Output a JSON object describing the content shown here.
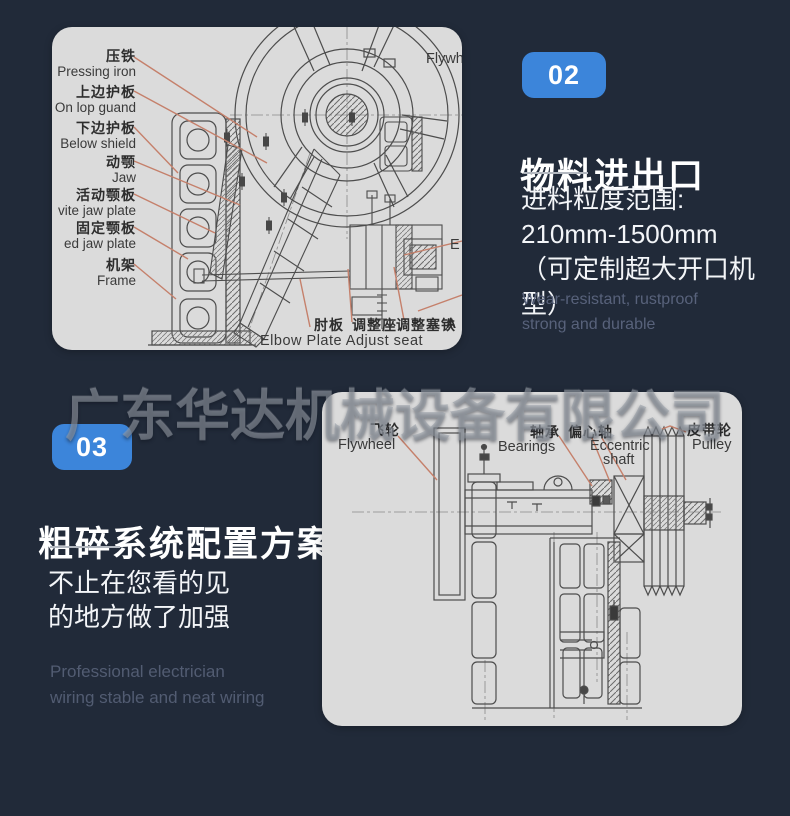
{
  "watermark": "广东华达机械设备有限公司",
  "colors": {
    "background": "#212a39",
    "panel_bg": "#dbdbdb",
    "accent_blue": "#3c85da",
    "leader_line": "#c5806b",
    "diagram_stroke": "#4d4d4d"
  },
  "section2": {
    "badge": "02",
    "title": "物料进出口",
    "lines": "进料粒度范围:\n210mm-1500mm\n（可定制超大开口机型）",
    "subtext": "Wear-resistant, rustproof\nstrong and durable"
  },
  "section3": {
    "badge": "03",
    "title": "粗碎系统配置方案",
    "lines": "不止在您看的见\n的地方做了加强",
    "subtext": "Professional electrician\nwiring stable and neat wiring"
  },
  "diagram1": {
    "labels": [
      {
        "zh": "压铁",
        "en": "Pressing iron"
      },
      {
        "zh": "上边护板",
        "en": "On lop guand"
      },
      {
        "zh": "下边护板",
        "en": "Below shield"
      },
      {
        "zh": "动颚",
        "en": "Jaw"
      },
      {
        "zh": "活动颚板",
        "en": "vite jaw plate"
      },
      {
        "zh": "固定颚板",
        "en": "ed jaw plate"
      },
      {
        "zh": "机架",
        "en": "Frame"
      }
    ],
    "flywheel_label": "Flywheel",
    "partial_right_label": "E",
    "bottom_zh": [
      "肘板",
      "调整座",
      "调整塞铁",
      "A"
    ],
    "bottom_en": "Elbow Plate Adjust seat"
  },
  "diagram2": {
    "flywheel": {
      "zh": "飞轮",
      "en": "Flywheel"
    },
    "bearings": {
      "zh": "轴承",
      "en": "Bearings"
    },
    "eccentric": {
      "zh": "偏心轴",
      "en1": "Eccentric",
      "en2": "shaft"
    },
    "pulley": {
      "zh": "皮带轮",
      "en": "Pulley"
    }
  }
}
